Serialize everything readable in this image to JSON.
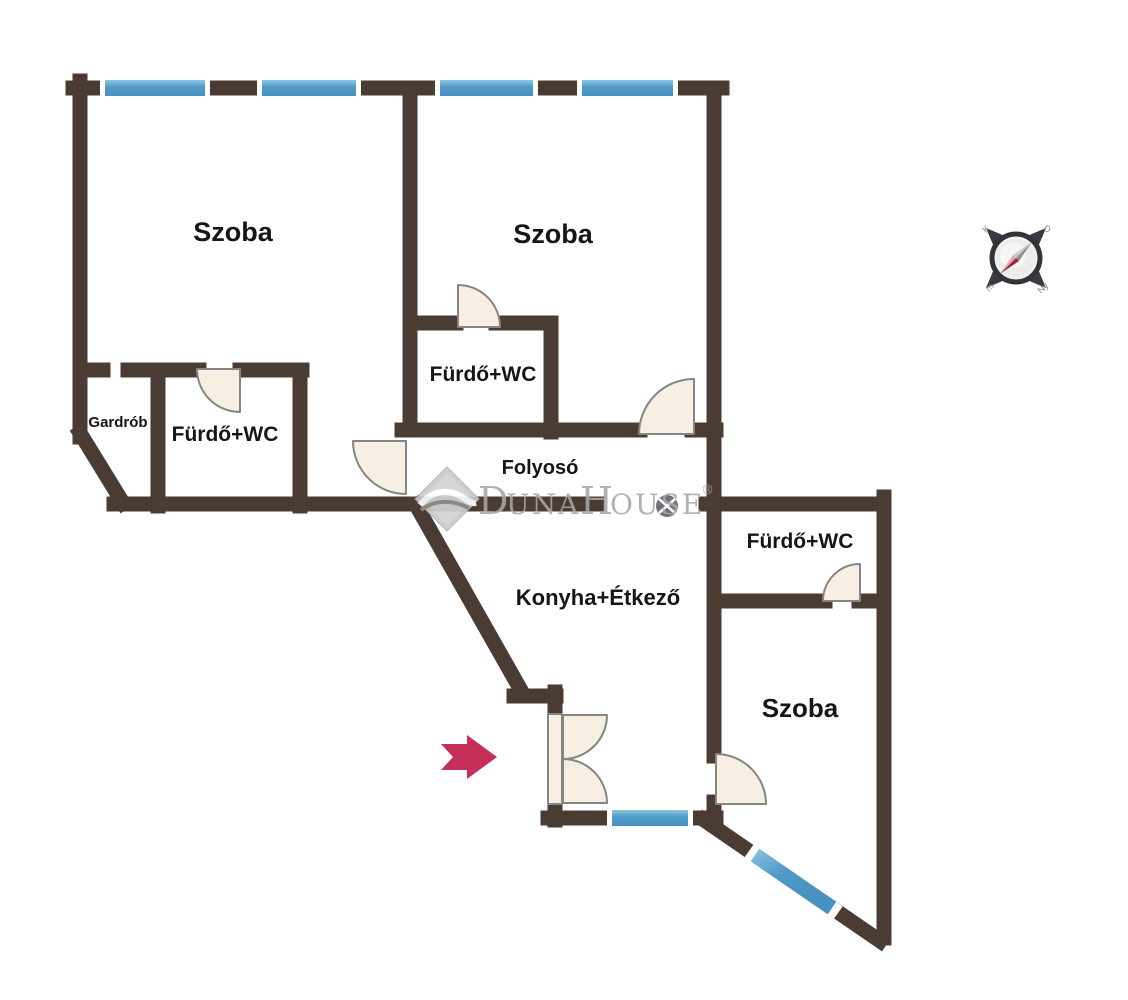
{
  "plan": {
    "rooms": [
      {
        "id": "szoba-1",
        "label": "Szoba"
      },
      {
        "id": "szoba-2",
        "label": "Szoba"
      },
      {
        "id": "furdo-wc-middle",
        "label": "Fürdő+WC"
      },
      {
        "id": "gardrob",
        "label": "Gardrób"
      },
      {
        "id": "furdo-wc-left",
        "label": "Fürdő+WC"
      },
      {
        "id": "folyoso",
        "label": "Folyosó"
      },
      {
        "id": "konyha-etkezo",
        "label": "Konyha+Étkező"
      },
      {
        "id": "furdo-wc-right",
        "label": "Fürdő+WC"
      },
      {
        "id": "szoba-3",
        "label": "Szoba"
      }
    ],
    "colors": {
      "wall": "#4a3b33",
      "window_blue": "#4f9ac7",
      "window_blue_light": "#8ec6e2",
      "door_fill": "#f7efe2",
      "arrow_red": "#c4305a",
      "watermark_gray": "#a8a8a8"
    }
  },
  "watermark": {
    "brand": "Duna House",
    "d": "D",
    "una": "UNA",
    "h": "H",
    "ouse": "OUSE",
    "registered": "®"
  },
  "compass": {
    "nw": "K",
    "ne": "D",
    "se": "Ny",
    "sw": "É"
  }
}
